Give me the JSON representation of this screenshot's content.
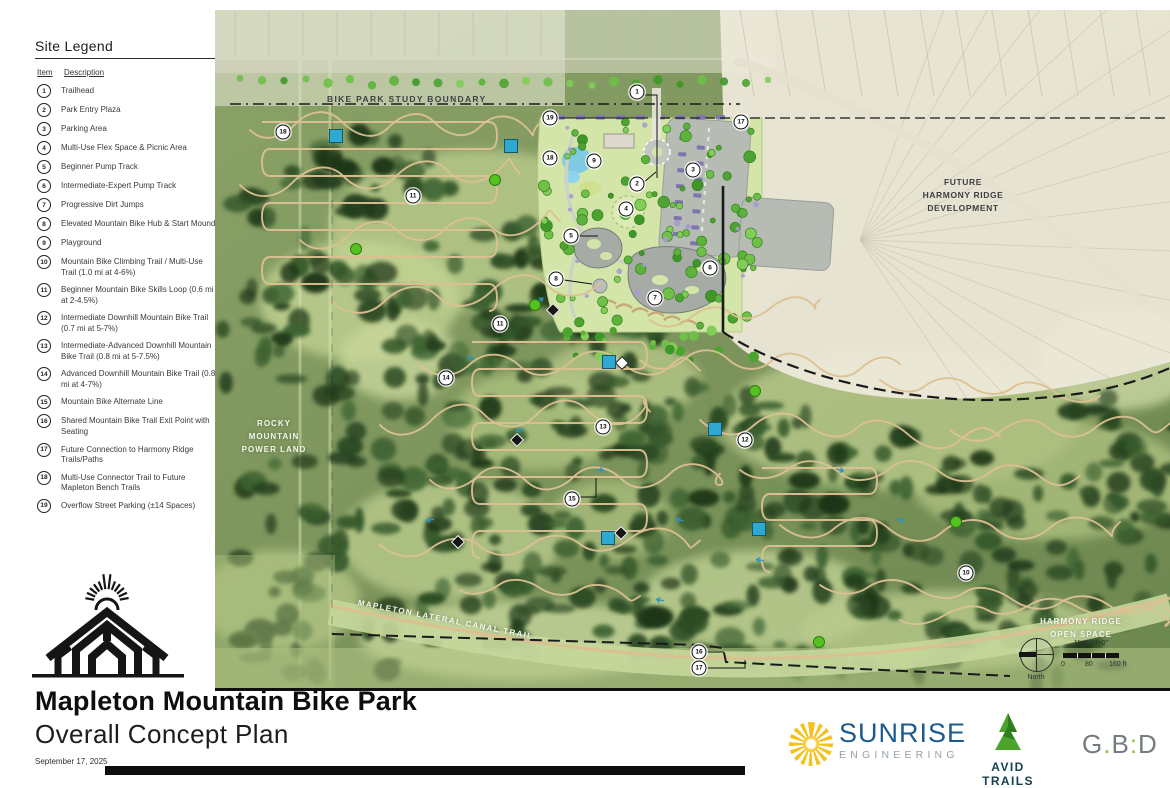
{
  "legend": {
    "title": "Site Legend",
    "col_item": "Item",
    "col_description": "Description",
    "items": [
      {
        "num": "1",
        "text": "Trailhead"
      },
      {
        "num": "2",
        "text": "Park Entry Plaza"
      },
      {
        "num": "3",
        "text": "Parking Area"
      },
      {
        "num": "4",
        "text": "Multi-Use Flex Space & Picnic Area"
      },
      {
        "num": "5",
        "text": "Beginner Pump Track"
      },
      {
        "num": "6",
        "text": "Intermediate-Expert Pump Track"
      },
      {
        "num": "7",
        "text": "Progressive Dirt Jumps"
      },
      {
        "num": "8",
        "text": "Elevated Mountain Bike Hub & Start Mound"
      },
      {
        "num": "9",
        "text": "Playground"
      },
      {
        "num": "10",
        "text": "Mountain Bike Climbing Trail / Multi-Use Trail (1.0 mi at 4-6%)"
      },
      {
        "num": "11",
        "text": "Beginner Mountain Bike Skills Loop (0.6 mi at 2-4.5%)"
      },
      {
        "num": "12",
        "text": "Intermediate Downhill Mountain Bike Trail (0.7 mi at 5-7%)"
      },
      {
        "num": "13",
        "text": "Intermediate-Advanced Downhill Mountain Bike Trail (0.8 mi at 5-7.5%)"
      },
      {
        "num": "14",
        "text": "Advanced Downhill Mountain Bike Trail (0.8 mi at 4-7%)"
      },
      {
        "num": "15",
        "text": "Mountain Bike Alternate Line"
      },
      {
        "num": "16",
        "text": "Shared Mountain Bike Trail Exit Point with Seating"
      },
      {
        "num": "17",
        "text": "Future Connection to Harmony Ridge Trails/Paths"
      },
      {
        "num": "18",
        "text": "Multi-Use Connector Trail to Future Mapleton Bench Trails"
      },
      {
        "num": "19",
        "text": "Overflow Street Parking (±14 Spaces)"
      }
    ]
  },
  "map": {
    "boundary_label": "BIKE PARK STUDY BOUNDARY",
    "future_dev": [
      "FUTURE",
      "HARMONY RIDGE",
      "DEVELOPMENT"
    ],
    "rocky": [
      "ROCKY",
      "MOUNTAIN",
      "POWER LAND"
    ],
    "canal_label": "MAPLETON LATERAL CANAL TRAIL",
    "harmony_open": [
      "HARMONY RIDGE",
      "OPEN SPACE"
    ],
    "scale": {
      "ratio": "1\" = 80'-0\"",
      "tick0": "0",
      "tick1": "80",
      "tick2": "160 ft",
      "north": "North"
    },
    "markers": [
      {
        "n": "1",
        "x": 637,
        "y": 92
      },
      {
        "n": "19",
        "x": 550,
        "y": 118
      },
      {
        "n": "17",
        "x": 741,
        "y": 122
      },
      {
        "n": "18",
        "x": 283,
        "y": 132
      },
      {
        "n": "18",
        "x": 550,
        "y": 158
      },
      {
        "n": "9",
        "x": 594,
        "y": 161
      },
      {
        "n": "3",
        "x": 693,
        "y": 170
      },
      {
        "n": "2",
        "x": 637,
        "y": 184
      },
      {
        "n": "11",
        "x": 413,
        "y": 196
      },
      {
        "n": "4",
        "x": 626,
        "y": 209
      },
      {
        "n": "5",
        "x": 571,
        "y": 236
      },
      {
        "n": "6",
        "x": 710,
        "y": 268
      },
      {
        "n": "8",
        "x": 556,
        "y": 279
      },
      {
        "n": "7",
        "x": 655,
        "y": 298
      },
      {
        "n": "11",
        "x": 500,
        "y": 324
      },
      {
        "n": "14",
        "x": 446,
        "y": 378
      },
      {
        "n": "13",
        "x": 603,
        "y": 427
      },
      {
        "n": "12",
        "x": 745,
        "y": 440
      },
      {
        "n": "15",
        "x": 572,
        "y": 499
      },
      {
        "n": "10",
        "x": 966,
        "y": 573
      },
      {
        "n": "16",
        "x": 699,
        "y": 652
      },
      {
        "n": "17",
        "x": 699,
        "y": 668
      }
    ],
    "blue_squares": [
      [
        336,
        136
      ],
      [
        511,
        146
      ],
      [
        609,
        362
      ],
      [
        715,
        429
      ],
      [
        759,
        529
      ],
      [
        608,
        538
      ]
    ],
    "green_dots": [
      [
        495,
        180
      ],
      [
        356,
        249
      ],
      [
        535,
        305
      ],
      [
        755,
        391
      ],
      [
        956,
        522
      ],
      [
        819,
        642
      ]
    ],
    "black_diamonds": [
      [
        553,
        310
      ],
      [
        517,
        440
      ],
      [
        458,
        542
      ],
      [
        621,
        533
      ]
    ],
    "white_diamonds": [
      [
        622,
        363
      ]
    ]
  },
  "title_block": {
    "title": "Mapleton Mountain Bike Park",
    "subtitle": "Overall Concept Plan",
    "date": "September 17, 2025"
  },
  "logos": {
    "sunrise": "SUNRISE",
    "sunrise_sub": "ENGINEERING",
    "avid": "AVID TRAILS",
    "gbd": "G.B:D"
  },
  "colors": {
    "blue_marker": "#2fa9d1",
    "green_marker": "#54c320",
    "trail_tan": "#dcc092",
    "boundary": "#1a1a1a"
  }
}
